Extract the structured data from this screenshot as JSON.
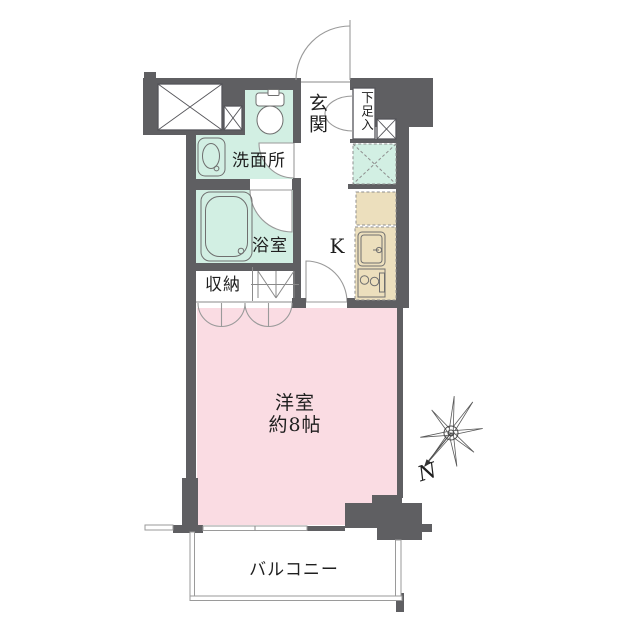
{
  "floorplan": {
    "labels": {
      "genkan": "玄関",
      "shoebox": "下足入",
      "washroom": "洗面所",
      "bathroom": "浴室",
      "kitchen": "K",
      "closet": "収納",
      "room_name": "洋室",
      "room_size": "約8帖",
      "balcony": "バルコニー",
      "north": "N"
    },
    "colors": {
      "wall": "#5f5f62",
      "mint": "#d2efe3",
      "pink": "#fadce3",
      "beige": "#ecdfbd"
    }
  }
}
